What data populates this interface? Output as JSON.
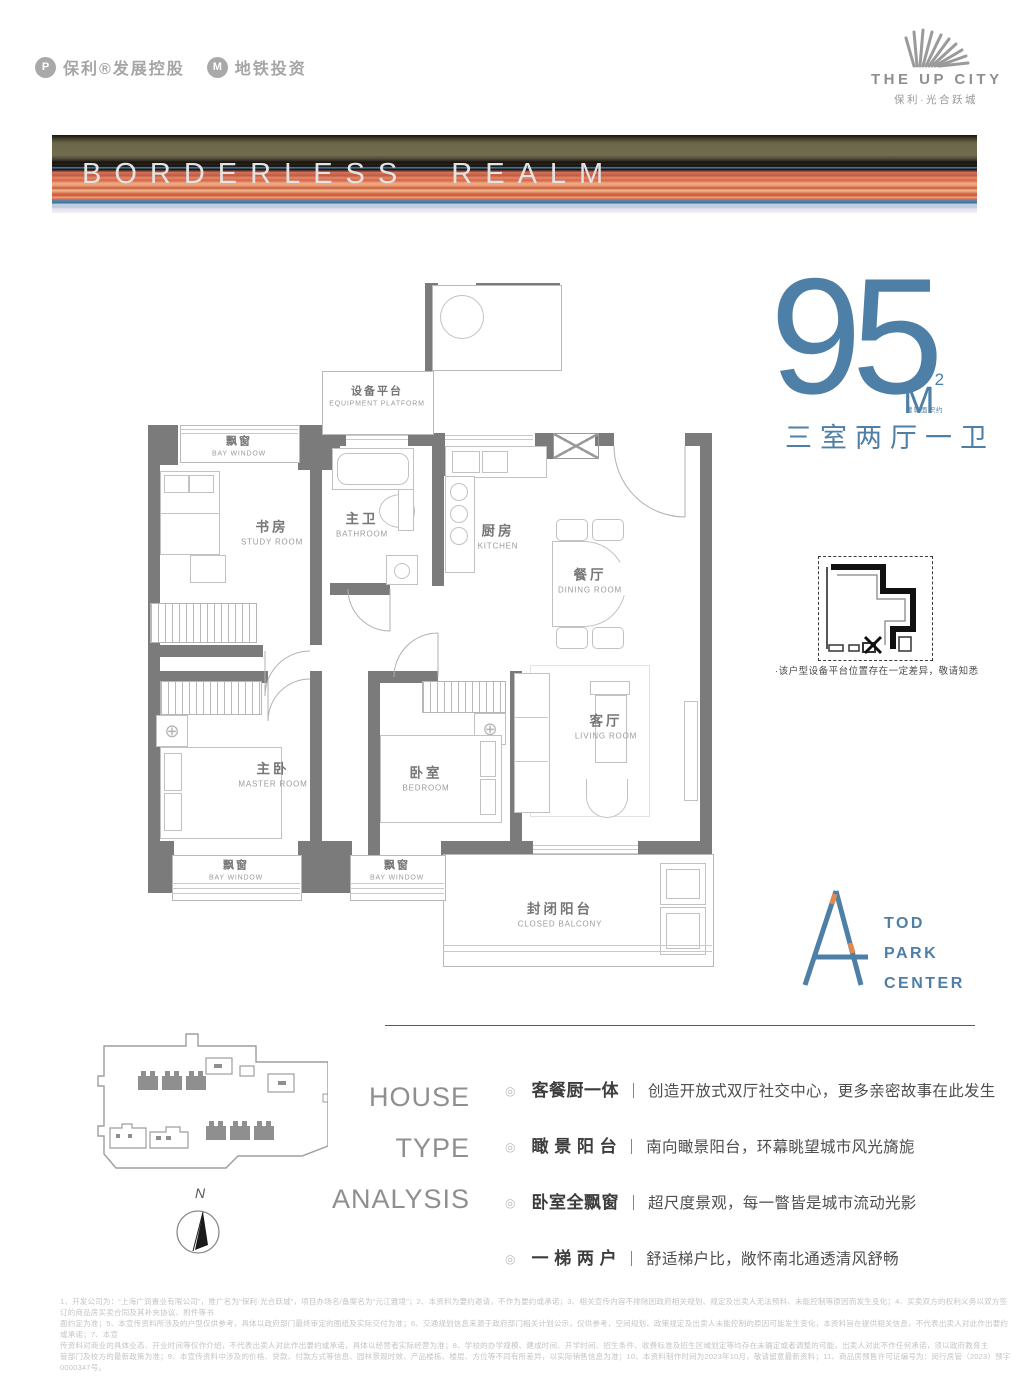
{
  "header": {
    "logo1_text": "保利®发展控股",
    "logo1_glyph": "P",
    "logo2_text": "地铁投资",
    "logo2_glyph": "M",
    "brand_name": "THE UP CITY",
    "brand_subtitle": "保利·光合跃城"
  },
  "banner": {
    "title": "BORDERLESS REALM"
  },
  "area": {
    "value": "95",
    "unit": "M",
    "unit_sup": "2",
    "unit_note": "建筑面积约",
    "layout": "三室两厅一卫"
  },
  "floorplan": {
    "rooms": {
      "equipment": {
        "cn": "设备平台",
        "en": "EQUIPMENT PLATFORM"
      },
      "bay_top": {
        "cn": "飘窗",
        "en": "BAY WINDOW"
      },
      "study": {
        "cn": "书房",
        "en": "STUDY ROOM"
      },
      "bath": {
        "cn": "主卫",
        "en": "BATHROOM"
      },
      "kitchen": {
        "cn": "厨房",
        "en": "KITCHEN"
      },
      "dining": {
        "cn": "餐厅",
        "en": "DINING ROOM"
      },
      "master": {
        "cn": "主卧",
        "en": "MASTER ROOM"
      },
      "bedroom": {
        "cn": "卧室",
        "en": "BEDROOM"
      },
      "living": {
        "cn": "客厅",
        "en": "LIVING ROOM"
      },
      "bay_master": {
        "cn": "飘窗",
        "en": "BAY WINDOW"
      },
      "bay_bedroom": {
        "cn": "飘窗",
        "en": "BAY WINDOW"
      },
      "balcony": {
        "cn": "封闭阳台",
        "en": "CLOSED BALCONY"
      }
    }
  },
  "inset": {
    "note": "·该户型设备平台位置存在一定差异，敬请知悉"
  },
  "tod_logo": {
    "letter": "A",
    "lines": [
      "TOD",
      "PARK",
      "CENTER"
    ]
  },
  "site_plan": {
    "compass_label": "N"
  },
  "analysis": {
    "title_lines": [
      "HOUSE",
      "TYPE",
      "ANALYSIS"
    ],
    "bullet_icon": "◎",
    "separator": "｜",
    "items": [
      {
        "feature": "客餐厨一体",
        "desc": "创造开放式双厅社交中心，更多亲密故事在此发生"
      },
      {
        "feature": "瞰 景 阳 台",
        "desc": "南向瞰景阳台，环幕眺望城市风光旖旎"
      },
      {
        "feature": "卧室全飘窗",
        "desc": "超尺度景观，每一瞥皆是城市流动光影"
      },
      {
        "feature": "一 梯 两 户",
        "desc": "舒适梯户比，敞怀南北通透清风舒畅"
      }
    ]
  },
  "disclaimer": {
    "lines": [
      "1、开发公司为：“上海广润置业有限公司”，推广名为“保利·光合跃城”，项目办场名/备案名为“元江雅境”；2、本资料为要约邀请，不作为要约或承诺；3、相关宣传内容不排除因政府相关规划、规定及出卖人无法预料、未能控制等原因而发生变化；4、买卖双方的权利义务以双方签订的商品房买卖合同及其补充协议、附件等书",
      "面约定为准；5、本宣传资料所涉及的户型仅供参考，具体以政府部门最终审定的图纸及实际交付为准；6、交通规划信息来源于政府部门相关计划公示，仅供参考，空间规划、政策规定及出卖人未能控制的原因可能发生变化，本资料旨在提供相关信息，不代表出卖人对此作出要约或承诺；7、本宣",
      "传资料对商业的具体业态、开业时间等仅作介绍，不代表出卖人对此作出要约或承诺，具体以经营者实际经营为准；8、学校的办学规模、建成时间、开学时间、招生条件、收费标准及招生区域划定等均存在未确定或者调整的可能，出卖人对此不作任何承诺，须以政府教育主",
      "管部门及校方的最新政策为准；9、本宣传资料中涉及的价格、贷款、付款方式等信息、园林景观时效、产品楼栋、楼层、方位等不同有所差异，以实际销售信息为准；10、本资料制作时间为2023年10月，敬请留意最新资料；11、商品房预售许可证编号为：闵行房管（2023）预字0000347号。"
    ]
  }
}
